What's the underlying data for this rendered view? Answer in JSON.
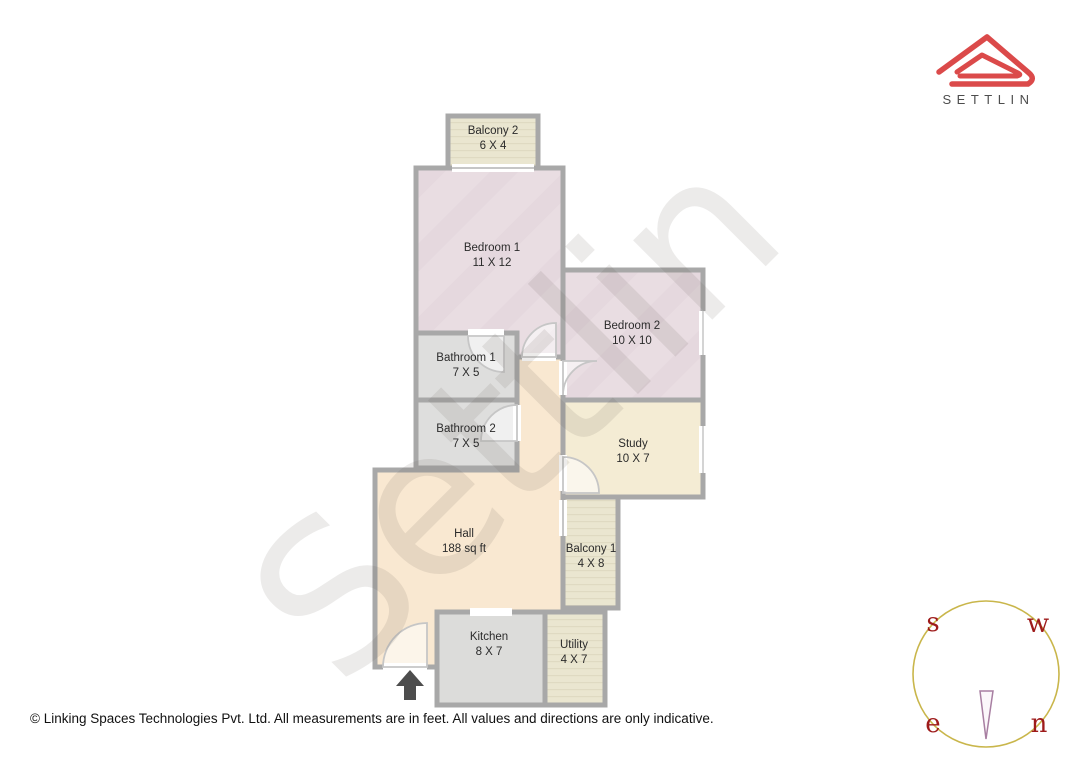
{
  "logo": {
    "brand": "SETTLIN",
    "accent_color": "#db4a4a",
    "brand_text_color": "#4d4d4d"
  },
  "watermark": {
    "text": "Settlin"
  },
  "rooms": [
    {
      "id": "balcony2",
      "name": "Balcony 2",
      "dims": "6 X 4"
    },
    {
      "id": "bedroom1",
      "name": "Bedroom 1",
      "dims": "11 X 12"
    },
    {
      "id": "bedroom2",
      "name": "Bedroom 2",
      "dims": "10 X 10"
    },
    {
      "id": "bathroom1",
      "name": "Bathroom 1",
      "dims": "7 X 5"
    },
    {
      "id": "bathroom2",
      "name": "Bathroom 2",
      "dims": "7 X 5"
    },
    {
      "id": "study",
      "name": "Study",
      "dims": "10 X 7"
    },
    {
      "id": "hall",
      "name": "Hall",
      "dims": "188 sq ft"
    },
    {
      "id": "balcony1",
      "name": "Balcony 1",
      "dims": "4 X 8"
    },
    {
      "id": "kitchen",
      "name": "Kitchen",
      "dims": "8 X 7"
    },
    {
      "id": "utility",
      "name": "Utility",
      "dims": "4 X 7"
    }
  ],
  "compass": {
    "top_left": "s",
    "top_right": "w",
    "bottom_left": "e",
    "bottom_right": "n",
    "circle_color": "#c9b64b",
    "letter_color": "#9e1b1b",
    "needle_color": "#a87fa2"
  },
  "footer": {
    "text": "© Linking Spaces Technologies Pvt. Ltd. All measurements are in feet. All values and directions are only indicative."
  },
  "colors": {
    "wall": "#a8a8a8",
    "bedroom_fill": "#e9dde2",
    "bathroom_fill": "#dededd",
    "study_fill": "#f4ecd4",
    "hall_fill": "#f9e8d1",
    "balcony_fill": "#eae6d0",
    "kitchen_fill": "#dcdcda",
    "entrance_arrow": "#4d4d4d"
  }
}
